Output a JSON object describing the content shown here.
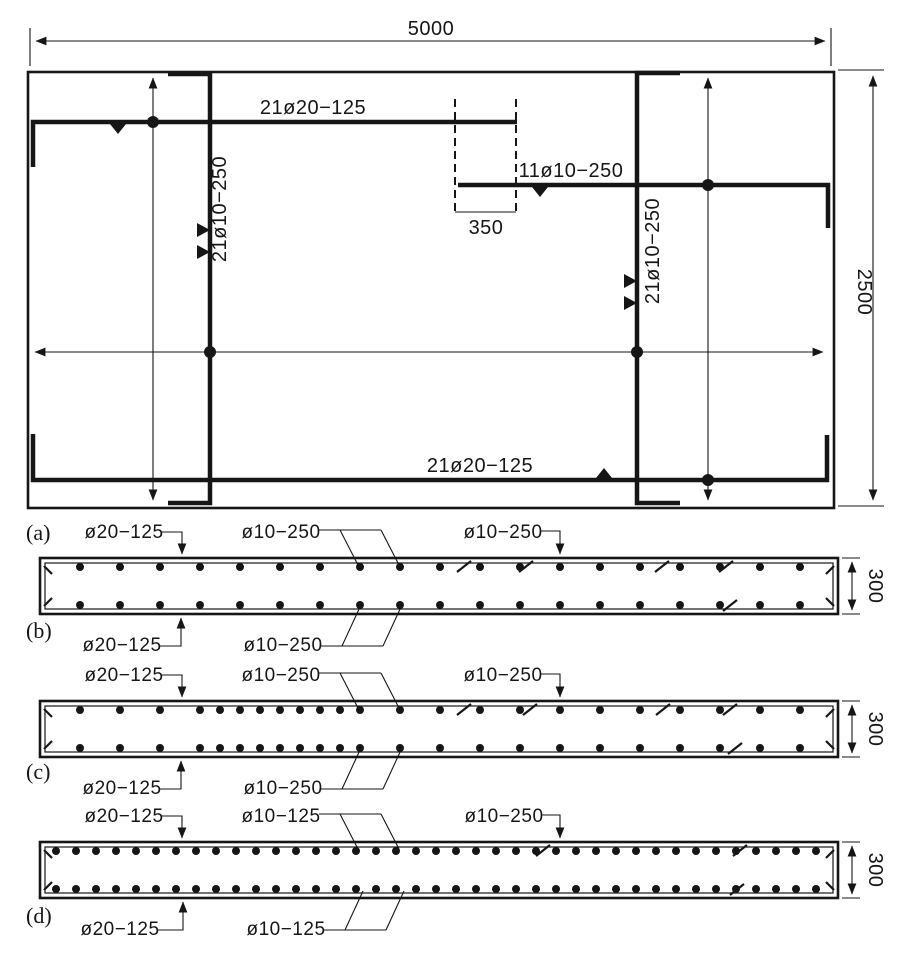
{
  "plan": {
    "width_dim": "5000",
    "height_dim": "2500",
    "caption": "(a)",
    "top_bar_label": "21ø20−125",
    "bottom_bar_label": "21ø20−125",
    "left_col_label": "21ø10−250",
    "right_col_label": "21ø10−250",
    "mid_bar_label": "11ø10−250",
    "lap_dim": "350"
  },
  "sections": [
    {
      "caption": "(b)",
      "top_main": "ø20−125",
      "top_dist": "ø10−250",
      "top_right": "ø10−250",
      "bot_main": "ø20−125",
      "bot_dist": "ø10−250",
      "depth": "300",
      "geom": {
        "y": 558,
        "h": 56,
        "start": 80,
        "end": 820,
        "step": 40,
        "dense": null,
        "top_ticks": [
          464,
          526,
          662,
          726
        ],
        "bot_ticks": [
          730
        ]
      }
    },
    {
      "caption": "(c)",
      "top_main": "ø20−125",
      "top_dist": "ø10−250",
      "top_right": "ø10−250",
      "bot_main": "ø20−125",
      "bot_dist": "ø10−250",
      "depth": "300",
      "geom": {
        "y": 701,
        "h": 56,
        "start": 80,
        "end": 820,
        "step": 40,
        "dense": [
          200,
          360
        ],
        "top_ticks": [
          464,
          530,
          663,
          730
        ],
        "bot_ticks": [
          735
        ]
      }
    },
    {
      "caption": "(d)",
      "top_main": "ø20−125",
      "top_dist": "ø10−125",
      "top_right": "ø10−250",
      "bot_main": "ø20−125",
      "bot_dist": "ø10−125",
      "depth": "300",
      "geom": {
        "y": 842,
        "h": 56,
        "start": 56,
        "end": 824,
        "step": 20,
        "dense": null,
        "top_ticks": [
          543,
          740
        ],
        "bot_ticks": [
          737
        ]
      }
    }
  ]
}
